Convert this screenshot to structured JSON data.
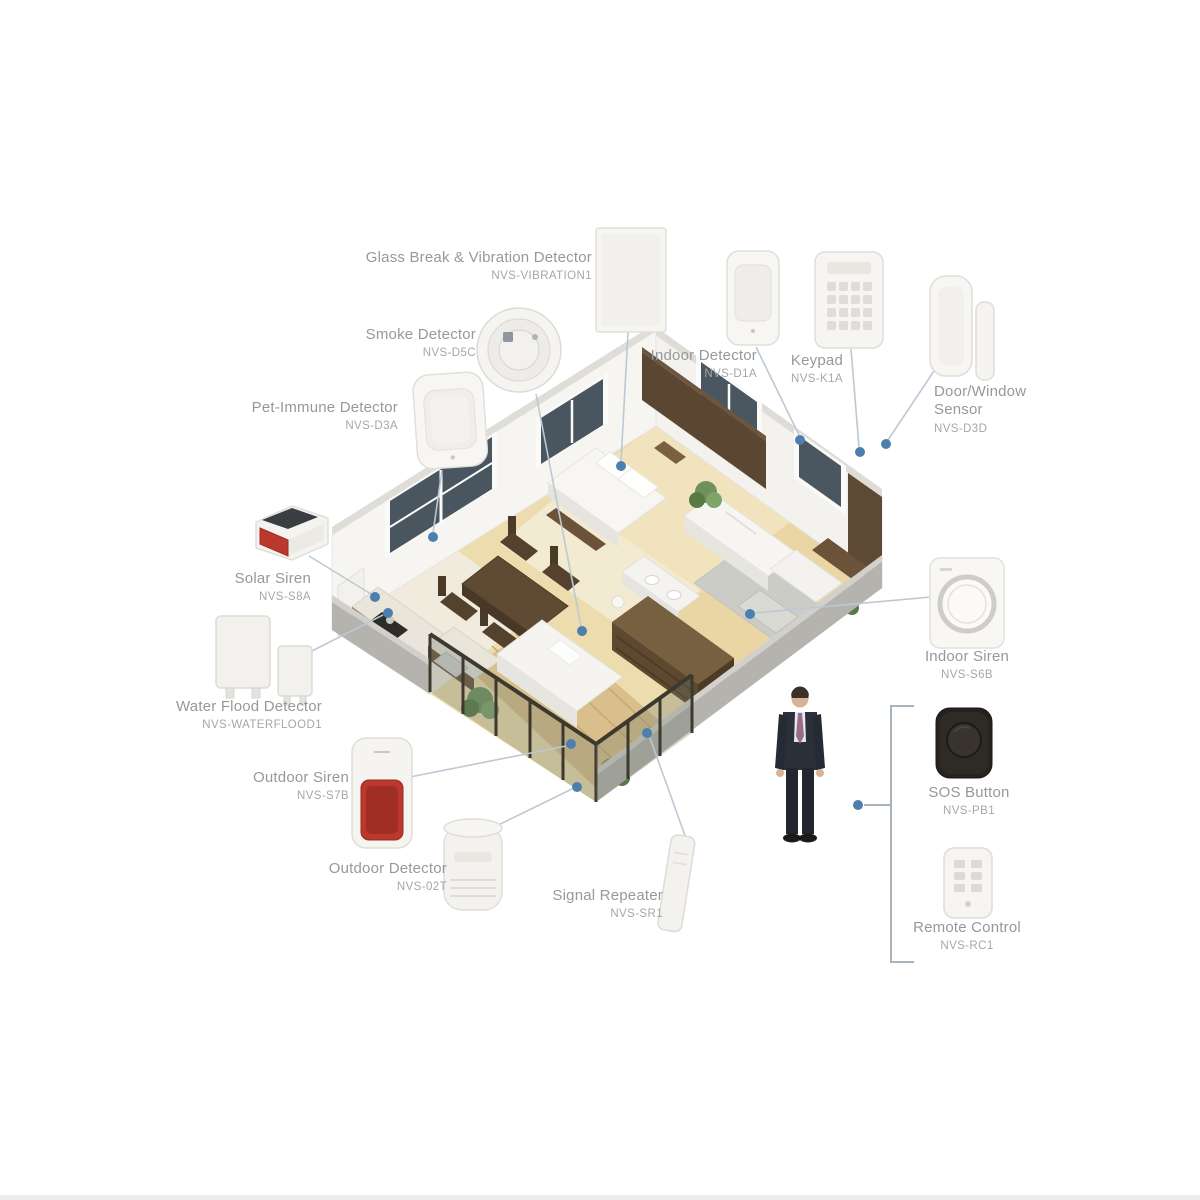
{
  "colors": {
    "label-text": "#96989b",
    "model-text": "#a5a7aa",
    "connector-line": "#bcc9d4",
    "connector-dot": "#4d7fae",
    "bracket-line": "#a9b3bb",
    "siren-red": "#bb382d",
    "solar-panel-dark": "#3a3d42",
    "wood-floor": "#ecdcae",
    "wall-white": "#f6f5f1",
    "furniture-brown": "#6b5238",
    "fence-dark": "#3d392f"
  },
  "devices": [
    {
      "name": "Glass Break & Vibration Detector",
      "model": "NVS-VIBRATION1"
    },
    {
      "name": "Smoke Detector",
      "model": "NVS-D5C"
    },
    {
      "name": "Pet-Immune Detector",
      "model": "NVS-D3A"
    },
    {
      "name": "Indoor Detector",
      "model": "NVS-D1A"
    },
    {
      "name": "Keypad",
      "model": "NVS-K1A"
    },
    {
      "name": "Door/Window Sensor",
      "model": "NVS-D3D"
    },
    {
      "name": "Solar Siren",
      "model": "NVS-S8A"
    },
    {
      "name": "Water Flood Detector",
      "model": "NVS-WATERFLOOD1"
    },
    {
      "name": "Outdoor Siren",
      "model": "NVS-S7B"
    },
    {
      "name": "Outdoor Detector",
      "model": "NVS-02T"
    },
    {
      "name": "Signal Repeater",
      "model": "NVS-SR1"
    },
    {
      "name": "Indoor Siren",
      "model": "NVS-S6B"
    },
    {
      "name": "SOS Button",
      "model": "NVS-PB1"
    },
    {
      "name": "Remote Control",
      "model": "NVS-RC1"
    }
  ]
}
